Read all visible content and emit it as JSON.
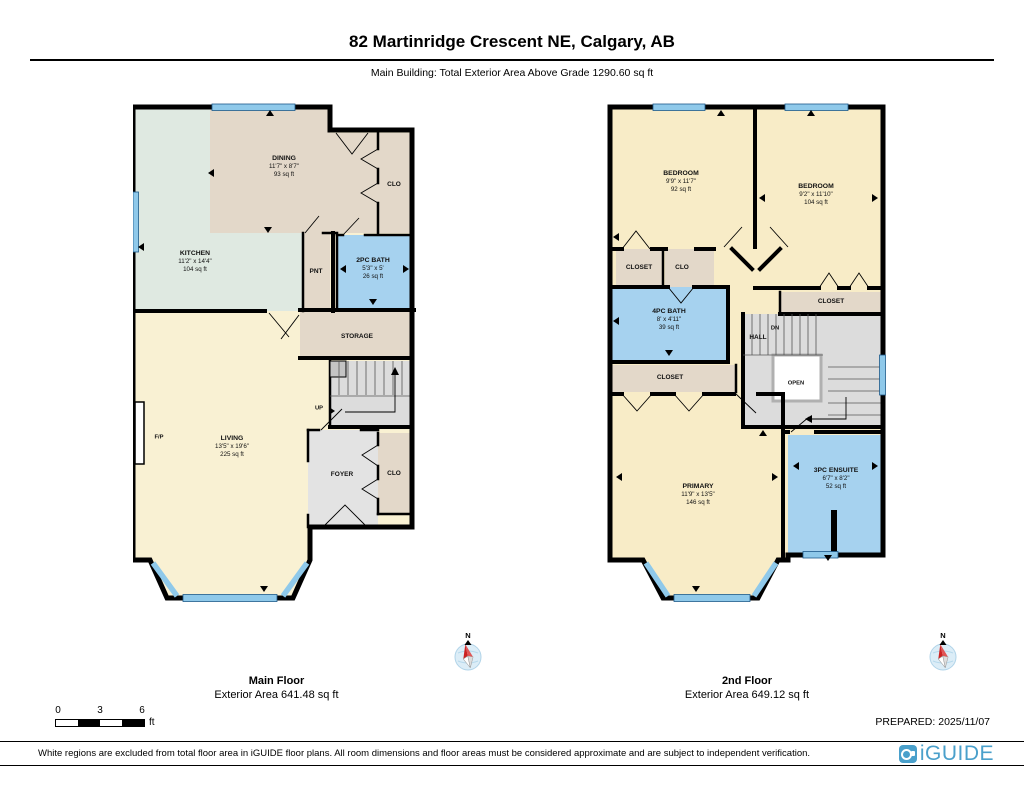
{
  "header": {
    "title": "82 Martinridge Crescent NE, Calgary, AB",
    "subtitle": "Main Building: Total Exterior Area Above Grade 1290.60 sq ft"
  },
  "floors": [
    {
      "caption_title": "Main Floor",
      "caption_area": "Exterior Area 641.48 sq ft",
      "rooms": {
        "dining": {
          "name": "DINING",
          "dims": "11'7\" x 8'7\"",
          "area": "93 sq ft"
        },
        "kitchen": {
          "name": "KITCHEN",
          "dims": "11'2\" x 14'4\"",
          "area": "104 sq ft"
        },
        "bath2": {
          "name": "2PC BATH",
          "dims": "5'3\" x 5'",
          "area": "26 sq ft"
        },
        "living": {
          "name": "LIVING",
          "dims": "13'5\" x 19'6\"",
          "area": "225 sq ft"
        },
        "clo_top": {
          "name": "CLO"
        },
        "pnt": {
          "name": "PNT"
        },
        "storage": {
          "name": "STORAGE"
        },
        "up": {
          "name": "UP"
        },
        "foyer": {
          "name": "FOYER"
        },
        "clo_bottom": {
          "name": "CLO"
        },
        "fp": {
          "name": "F/P"
        }
      }
    },
    {
      "caption_title": "2nd Floor",
      "caption_area": "Exterior Area 649.12 sq ft",
      "rooms": {
        "bed1": {
          "name": "BEDROOM",
          "dims": "9'9\" x 11'7\"",
          "area": "92 sq ft"
        },
        "bed2": {
          "name": "BEDROOM",
          "dims": "9'2\" x 11'10\"",
          "area": "104 sq ft"
        },
        "bath4": {
          "name": "4PC BATH",
          "dims": "8' x 4'11\"",
          "area": "39 sq ft"
        },
        "primary": {
          "name": "PRIMARY",
          "dims": "11'9\" x 13'5\"",
          "area": "146 sq ft"
        },
        "ensuite": {
          "name": "3PC ENSUITE",
          "dims": "6'7\" x 8'2\"",
          "area": "52 sq ft"
        },
        "closet1": {
          "name": "CLOSET"
        },
        "clo": {
          "name": "CLO"
        },
        "closet2": {
          "name": "CLOSET"
        },
        "closet3": {
          "name": "CLOSET"
        },
        "hall": {
          "name": "HALL"
        },
        "dn": {
          "name": "DN"
        },
        "open": {
          "name": "OPEN"
        }
      }
    }
  ],
  "compass": {
    "label": "N"
  },
  "scale_bar": {
    "ticks": [
      "0",
      "3",
      "6"
    ],
    "unit": "ft"
  },
  "prepared": "PREPARED: 2025/11/07",
  "footer": {
    "disclaimer": "White regions are excluded from total floor area in iGUIDE floor plans. All room dimensions and floor areas must be considered approximate and are subject to independent verification.",
    "logo_text": "iGUIDE"
  },
  "colors": {
    "wall": "#000000",
    "room_cream": "#f9f1d3",
    "room_cream2": "#f8ecc7",
    "room_mint": "#dfe9e1",
    "room_tan": "#e3d8c9",
    "room_blue": "#a6d2ef",
    "room_gray": "#e0e0e0",
    "window_blue": "#8fc9ea",
    "iguide_blue": "#4aa0cb"
  }
}
